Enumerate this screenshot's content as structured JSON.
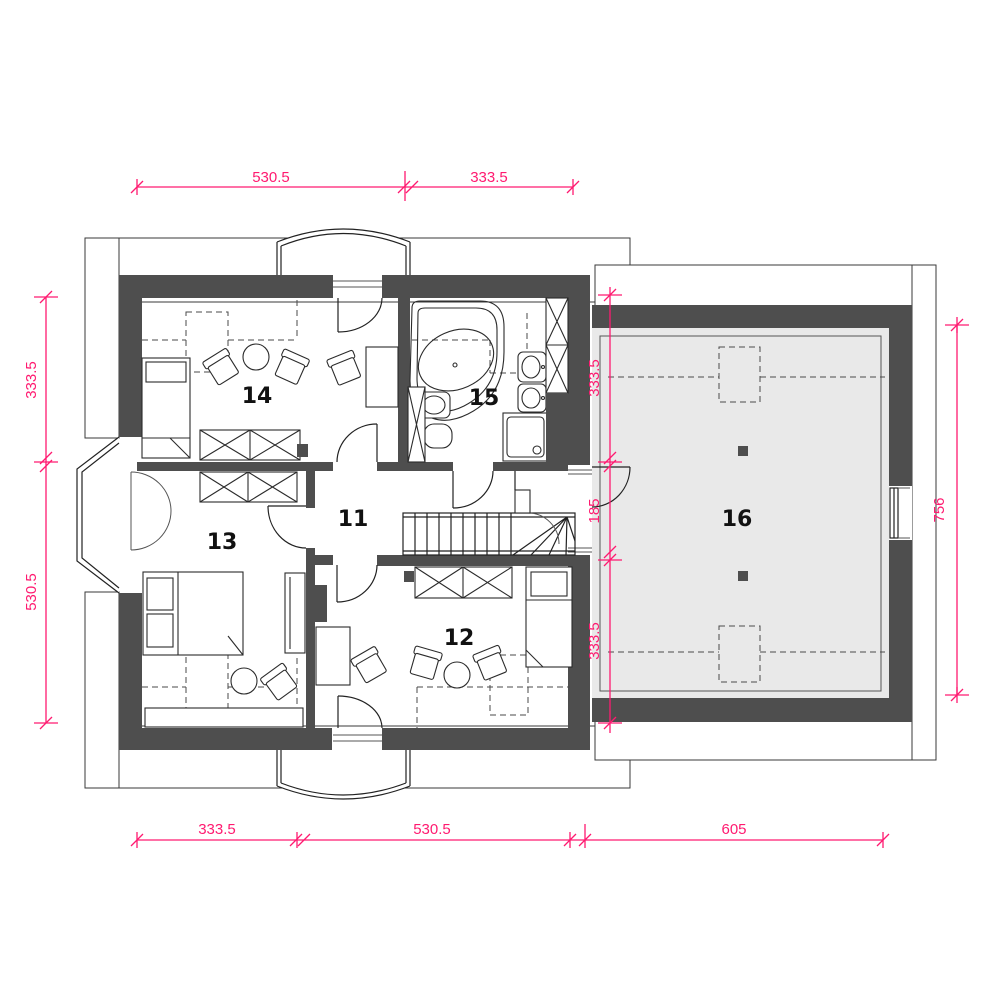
{
  "rooms": [
    "11",
    "12",
    "13",
    "14",
    "15",
    "16"
  ],
  "dimensions": {
    "top": [
      "530.5",
      "333.5"
    ],
    "left": [
      "333.5",
      "530.5"
    ],
    "middle_vertical": [
      "333.5",
      "185",
      "333.5"
    ],
    "right": [
      "756"
    ],
    "bottom": [
      "333.5",
      "530.5",
      "605"
    ]
  },
  "colors": {
    "wall": "#4e4e4e",
    "dimension_pink": "#ff1a70",
    "garage_floor": "#e9e9e9",
    "line": "#222222"
  }
}
